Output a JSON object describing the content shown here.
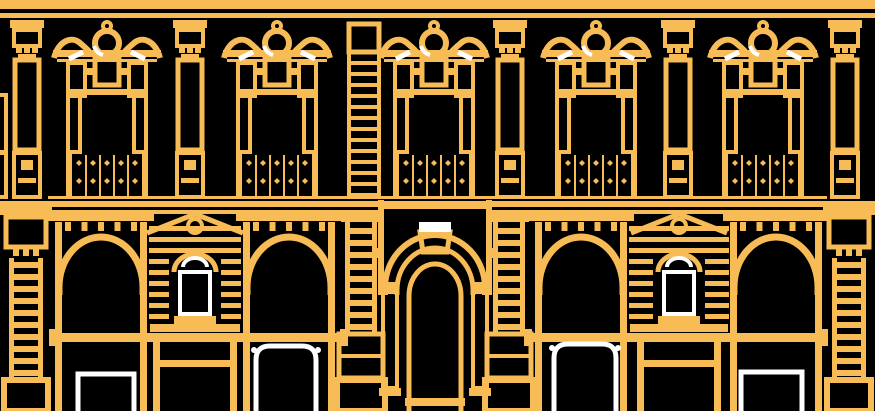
{
  "illustration": {
    "description": "Two-story classical palazzo facade drawn as amber line art with white accents on a black background",
    "canvas": {
      "width": 875,
      "height": 411
    },
    "colors": {
      "background": "#000000",
      "line": "#F8BC56",
      "accent": "#FFFFFF"
    },
    "top_cornice": {
      "bands": [
        {
          "y": 0,
          "h": 9
        },
        {
          "y": 13,
          "h": 5
        }
      ]
    },
    "upper_floor": {
      "window_centers": [
        107,
        277,
        434,
        596,
        763
      ],
      "pilaster_centers": [
        27,
        190,
        510,
        678,
        845
      ],
      "quoin_ladder": {
        "x": 349,
        "w": 30
      },
      "left_edge_fragment": {
        "x": -8,
        "y": 95,
        "w": 14,
        "h": 57
      }
    },
    "railing_band": {
      "top": 153,
      "bottom": 197
    },
    "string_courses": [
      {
        "x": 48,
        "y": 196,
        "w": 779,
        "h": 3
      },
      {
        "x": 0,
        "y": 201,
        "w": 875,
        "h": 6
      }
    ],
    "lower_floor": {
      "entablature": {
        "y": 210,
        "h": 11
      },
      "arch_bays": [
        {
          "l": 55,
          "r": 147
        },
        {
          "l": 243,
          "r": 335
        },
        {
          "l": 535,
          "r": 627
        },
        {
          "l": 730,
          "r": 822
        }
      ],
      "beams": [
        {
          "x1": 52,
          "x2": 345
        },
        {
          "x1": 527,
          "x2": 825
        }
      ],
      "niches": [
        {
          "l": 149,
          "r": 241,
          "c": 195
        },
        {
          "l": 629,
          "r": 729,
          "c": 679
        }
      ],
      "portal": {
        "l": 378,
        "r": 492,
        "c": 435
      },
      "portal_ladders": [
        {
          "x": 345,
          "w": 32
        },
        {
          "x": 493,
          "w": 32
        }
      ],
      "corner_pilasters": [
        {
          "c": 26
        },
        {
          "c": 849
        }
      ],
      "white_doors": {
        "rect": [
          {
            "x": 78,
            "w": 56,
            "y": 374
          },
          {
            "x": 741,
            "w": 61,
            "y": 372
          }
        ],
        "arched": [
          {
            "x": 256,
            "w": 60,
            "y": 346
          },
          {
            "x": 554,
            "w": 62,
            "y": 344
          }
        ]
      }
    }
  }
}
